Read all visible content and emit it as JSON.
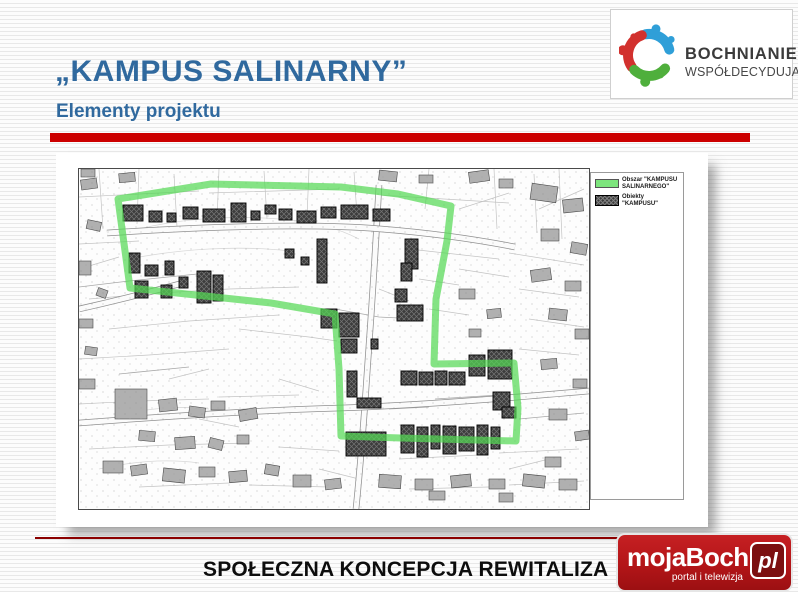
{
  "slide": {
    "title": "„KAMPUS SALINARNY”",
    "subtitle": "Elementy projektu",
    "footer": "SPOŁECZNA KONCEPCJA REWITALIZA"
  },
  "logo_top": {
    "line1": "BOCHNIANIE",
    "line2": "WSPÓŁDECYDUJĄ"
  },
  "logo_bottom": {
    "name": "mojaBochnia",
    "suffix": "pl",
    "tagline": "portal i telewizja"
  },
  "map": {
    "legend": [
      {
        "label": "Obszar \"KAMPUSU SALINARNEGO\"",
        "color": "#7de57d"
      },
      {
        "label": "Obiekty \"KAMPUSU\"",
        "color": "#3c3c3c"
      }
    ],
    "boundary_points": "39,30 132,15 262,18 319,25 372,37 368,72 357,130 355,195 435,194 439,239 437,272 322,269 262,267 260,200 256,145 192,134 51,119"
  },
  "colors": {
    "title_blue": "#30699e",
    "accent_red": "#cc0000",
    "rule_red": "#8b0000",
    "boundary_green": "#54d854",
    "logo_red": "#b31518",
    "logo_pl_dark": "#7c0f10"
  }
}
